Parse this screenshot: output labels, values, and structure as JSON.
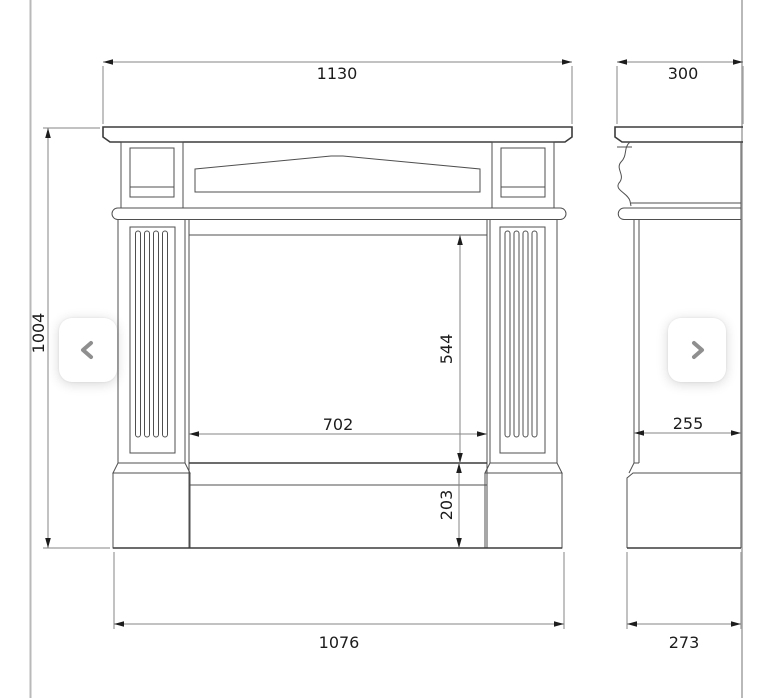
{
  "viewer": {
    "background": "#ffffff",
    "frame_border_color": "#b9b9b9",
    "prev_button": {
      "icon": "chevron-left"
    },
    "next_button": {
      "icon": "chevron-right"
    }
  },
  "drawing": {
    "line_color": "#4f4f4f",
    "dimension_color": "#868686",
    "label_color": "#1c1c1c",
    "front": {
      "top_width": "1130",
      "overall_height": "1004",
      "opening_width": "702",
      "opening_height": "544",
      "plinth_height": "203",
      "bottom_width": "1076"
    },
    "side": {
      "top_depth": "300",
      "column_depth": "255",
      "base_depth": "273"
    }
  }
}
